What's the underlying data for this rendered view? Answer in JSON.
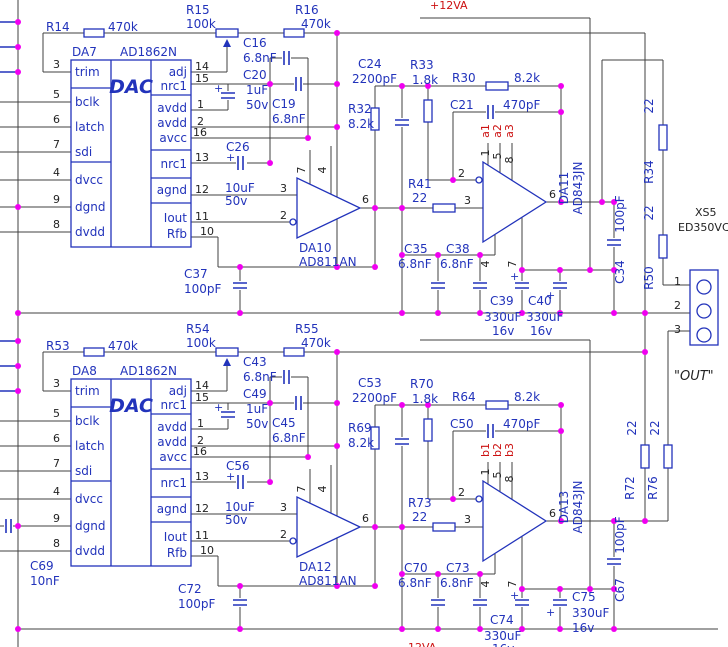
{
  "plus": "+",
  "connector": {
    "ref": "XS5",
    "part": "ED350VC",
    "p1": "1",
    "p2": "2",
    "p3": "3",
    "label": "\"OUT\""
  },
  "a": {
    "power_rail": "+12VA",
    "dac": {
      "ref": "DA7",
      "part": "AD1862N",
      "label": "DAC",
      "lp": [
        {
          "n": "3",
          "t": "trim"
        },
        {
          "n": "5",
          "t": "bclk"
        },
        {
          "n": "6",
          "t": "latch"
        },
        {
          "n": "7",
          "t": "sdi"
        },
        {
          "n": "4",
          "t": "dvcc"
        },
        {
          "n": "9",
          "t": "dgnd"
        },
        {
          "n": "8",
          "t": "dvdd"
        }
      ],
      "rp": [
        {
          "n": "14",
          "t": "adj"
        },
        {
          "n": "15",
          "t": "nrc1"
        },
        {
          "n": "1",
          "t": "avdd"
        },
        {
          "n": "2",
          "t": "avdd"
        },
        {
          "n": "16",
          "t": "avcc"
        },
        {
          "n": "13",
          "t": "nrc1"
        },
        {
          "n": "12",
          "t": "agnd"
        },
        {
          "n": "11",
          "t": "Iout"
        },
        {
          "n": "10",
          "t": "Rfb"
        }
      ]
    },
    "r14": {
      "r": "R14",
      "v": "470k"
    },
    "r15": {
      "r": "R15",
      "v": "100k"
    },
    "r16": {
      "r": "R16",
      "v": "470k"
    },
    "c16": {
      "r": "C16",
      "v": "6.8nF"
    },
    "c19": {
      "r": "C19",
      "v": "6.8nF"
    },
    "c20": {
      "r": "C20",
      "v": "1uF",
      "v2": "50v"
    },
    "c26": {
      "r": "C26",
      "v": "10uF",
      "v2": "50v"
    },
    "c37": {
      "r": "C37",
      "v": "100pF"
    },
    "op1": {
      "ref": "DA10",
      "part": "AD811AN",
      "p3": "3",
      "p2": "2",
      "p6": "6",
      "p7": "7",
      "p4": "4"
    },
    "c24": {
      "r": "C24",
      "v": "2200pF"
    },
    "r32": {
      "r": "R32",
      "v": "8.2k"
    },
    "r33": {
      "r": "R33",
      "v": "1.8k"
    },
    "r30": {
      "r": "R30",
      "v": "8.2k"
    },
    "c21": {
      "r": "C21",
      "v": "470pF"
    },
    "r41": {
      "r": "R41",
      "v": "22"
    },
    "op2": {
      "ref": "DA11",
      "part": "AD843JN",
      "p2": "2",
      "p3": "3",
      "p6": "6",
      "p1": "1",
      "p5": "5",
      "p8": "8",
      "p4": "4",
      "p7": "7",
      "t1": "a1",
      "t2": "a2",
      "t3": "a3"
    },
    "c35": {
      "r": "C35",
      "v": "6.8nF"
    },
    "c38": {
      "r": "C38",
      "v": "6.8nF"
    },
    "c39": {
      "r": "C39",
      "v": "330uF",
      "v2": "16v"
    },
    "c40": {
      "r": "C40",
      "v": "330uF",
      "v2": "16v"
    },
    "c34": {
      "r": "C34",
      "v": "100pF"
    },
    "r34": {
      "r": "R34",
      "v": "22"
    },
    "r50": {
      "r": "R50",
      "v": "22"
    }
  },
  "b": {
    "power_rail": "-12VA",
    "dac": {
      "ref": "DA8",
      "part": "AD1862N",
      "label": "DAC",
      "lp": [
        {
          "n": "3",
          "t": "trim"
        },
        {
          "n": "5",
          "t": "bclk"
        },
        {
          "n": "6",
          "t": "latch"
        },
        {
          "n": "7",
          "t": "sdi"
        },
        {
          "n": "4",
          "t": "dvcc"
        },
        {
          "n": "9",
          "t": "dgnd"
        },
        {
          "n": "8",
          "t": "dvdd"
        }
      ],
      "rp": [
        {
          "n": "14",
          "t": "adj"
        },
        {
          "n": "15",
          "t": "nrc1"
        },
        {
          "n": "1",
          "t": "avdd"
        },
        {
          "n": "2",
          "t": "avdd"
        },
        {
          "n": "16",
          "t": "avcc"
        },
        {
          "n": "13",
          "t": "nrc1"
        },
        {
          "n": "12",
          "t": "agnd"
        },
        {
          "n": "11",
          "t": "Iout"
        },
        {
          "n": "10",
          "t": "Rfb"
        }
      ]
    },
    "r53": {
      "r": "R53",
      "v": "470k"
    },
    "r54": {
      "r": "R54",
      "v": "100k"
    },
    "r55": {
      "r": "R55",
      "v": "470k"
    },
    "c43": {
      "r": "C43",
      "v": "6.8nF"
    },
    "c45": {
      "r": "C45",
      "v": "6.8nF"
    },
    "c49": {
      "r": "C49",
      "v": "1uF",
      "v2": "50v"
    },
    "c56": {
      "r": "C56",
      "v": "10uF",
      "v2": "50v"
    },
    "c72": {
      "r": "C72",
      "v": "100pF"
    },
    "c69": {
      "r": "C69",
      "v": "10nF"
    },
    "op1": {
      "ref": "DA12",
      "part": "AD811AN",
      "p3": "3",
      "p2": "2",
      "p6": "6",
      "p7": "7",
      "p4": "4"
    },
    "c53": {
      "r": "C53",
      "v": "2200pF"
    },
    "r69": {
      "r": "R69",
      "v": "8.2k"
    },
    "r70": {
      "r": "R70",
      "v": "1.8k"
    },
    "r64": {
      "r": "R64",
      "v": "8.2k"
    },
    "c50": {
      "r": "C50",
      "v": "470pF"
    },
    "r73": {
      "r": "R73",
      "v": "22"
    },
    "op2": {
      "ref": "DA13",
      "part": "AD843JN",
      "p2": "2",
      "p3": "3",
      "p6": "6",
      "p1": "1",
      "p5": "5",
      "p8": "8",
      "p4": "4",
      "p7": "7",
      "t1": "b1",
      "t2": "b2",
      "t3": "b3"
    },
    "c70": {
      "r": "C70",
      "v": "6.8nF"
    },
    "c73": {
      "r": "C73",
      "v": "6.8nF"
    },
    "c74": {
      "r": "C74",
      "v": "330uF",
      "v2": "16v"
    },
    "c75": {
      "r": "C75",
      "v": "330uF",
      "v2": "16v"
    },
    "c67": {
      "r": "C67",
      "v": "100pF"
    },
    "r72": {
      "r": "R72",
      "v": "22"
    },
    "r76": {
      "r": "R76",
      "v": "22"
    }
  }
}
